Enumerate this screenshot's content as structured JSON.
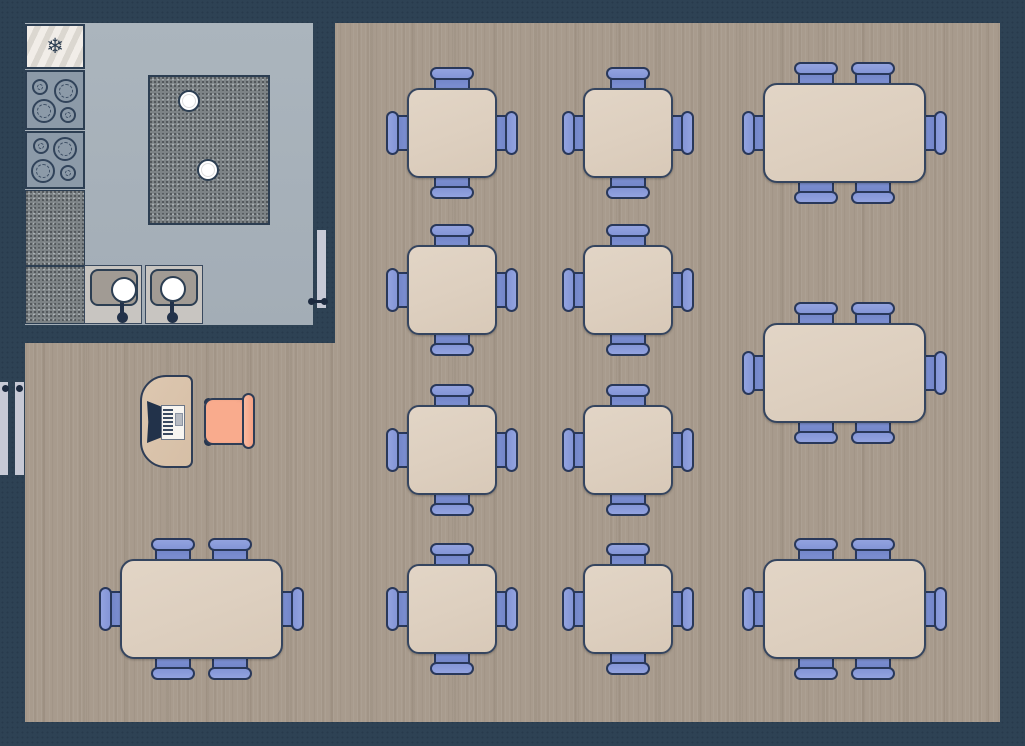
{
  "app": {
    "type": "floor-plan",
    "description": "Restaurant floor plan: kitchen (top-left) and dining area with tables and chairs"
  },
  "canvas": {
    "width": 1025,
    "height": 746
  },
  "colors": {
    "wall": "#2e4254",
    "kitchen_floor": "#a6b0b9",
    "wood_floor": "#a89b8d",
    "table_top": "#ddcfbf",
    "table_border": "#35455f",
    "chair_blue": "#7b8ed0",
    "chair_cap_blue": "#8a9bda",
    "chair_border": "#29385a",
    "desk_wood": "#d9c2a9",
    "office_chair_salmon": "#f9ab8d",
    "appliance_gray": "#8c9aa8",
    "fridge_light": "#e9e5e0",
    "granite": "#7d8386",
    "sink_counter": "#c8c5c1",
    "sink_basin": "#a19b94",
    "door_light": "#c7cad6",
    "hardware_dark": "#1d2b40"
  },
  "rooms": {
    "kitchen": {
      "label": "kitchen",
      "x": 25,
      "y": 23,
      "w": 288,
      "h": 302
    },
    "dining": {
      "label": "dining-area",
      "polygon": [
        [
          335,
          23
        ],
        [
          1000,
          23
        ],
        [
          1000,
          722
        ],
        [
          25,
          722
        ],
        [
          25,
          343
        ],
        [
          335,
          343
        ]
      ]
    }
  },
  "kitchen": {
    "fridge": {
      "x": 25,
      "y": 24,
      "w": 60,
      "h": 45,
      "icon": "❄",
      "icon_name": "snowflake-icon"
    },
    "stoves": [
      {
        "x": 25,
        "y": 70,
        "w": 60,
        "h": 60,
        "burners": [
          {
            "cx": 15,
            "cy": 17,
            "r": 8
          },
          {
            "cx": 41,
            "cy": 21,
            "r": 12
          },
          {
            "cx": 19,
            "cy": 41,
            "r": 12
          },
          {
            "cx": 43,
            "cy": 45,
            "r": 8
          }
        ]
      },
      {
        "x": 25,
        "y": 131,
        "w": 60,
        "h": 58,
        "burners": [
          {
            "cx": 16,
            "cy": 15,
            "r": 8
          },
          {
            "cx": 40,
            "cy": 18,
            "r": 12
          },
          {
            "cx": 18,
            "cy": 40,
            "r": 12
          },
          {
            "cx": 43,
            "cy": 42,
            "r": 8
          }
        ]
      }
    ],
    "counters": [
      {
        "x": 25,
        "y": 190,
        "w": 60,
        "h": 76
      },
      {
        "x": 25,
        "y": 266,
        "w": 60,
        "h": 58
      }
    ],
    "island": {
      "x": 148,
      "y": 75,
      "w": 122,
      "h": 150,
      "plates": [
        {
          "cx": 41,
          "cy": 26,
          "r": 11
        },
        {
          "cx": 60,
          "cy": 95,
          "r": 11
        }
      ]
    },
    "sinks": [
      {
        "x": 84,
        "y": 265,
        "w": 58,
        "h": 59,
        "basin": {
          "x": 6,
          "y": 4,
          "w": 48,
          "h": 37
        },
        "bowl": {
          "cx": 40,
          "cy": 25,
          "r": 13
        },
        "knob": {
          "cx": 38,
          "cy": 52,
          "r": 5.5
        }
      },
      {
        "x": 145,
        "y": 265,
        "w": 58,
        "h": 59,
        "basin": {
          "x": 5,
          "y": 4,
          "w": 48,
          "h": 37
        },
        "bowl": {
          "cx": 28,
          "cy": 24,
          "r": 13
        },
        "knob": {
          "cx": 27,
          "cy": 52,
          "r": 5.5
        }
      }
    ]
  },
  "doors": {
    "kitchen_door": {
      "x": 317,
      "y": 230,
      "w": 9,
      "h": 78,
      "handle": {
        "x1": 311,
        "x2": 324,
        "y": 301,
        "r": 3.5
      }
    },
    "service_door_panels": [
      {
        "x": 0,
        "y": 382,
        "w": 8,
        "h": 93,
        "knob": {
          "cx": 5,
          "cy": 388,
          "r": 3.5
        }
      },
      {
        "x": 15,
        "y": 382,
        "w": 9,
        "h": 93,
        "knob": {
          "cx": 19,
          "cy": 388,
          "r": 3.5
        }
      }
    ]
  },
  "dining": {
    "square_tables": {
      "seats": 4,
      "w": 90,
      "h": 90,
      "positions": [
        {
          "x": 407,
          "y": 88
        },
        {
          "x": 583,
          "y": 88
        },
        {
          "x": 407,
          "y": 245
        },
        {
          "x": 583,
          "y": 245
        },
        {
          "x": 407,
          "y": 405
        },
        {
          "x": 583,
          "y": 405
        },
        {
          "x": 407,
          "y": 564
        },
        {
          "x": 583,
          "y": 564
        }
      ]
    },
    "rect_tables": {
      "seats": 6,
      "w": 163,
      "h": 100,
      "chair_offsets_x": [
        53,
        110
      ],
      "positions": [
        {
          "x": 763,
          "y": 83
        },
        {
          "x": 763,
          "y": 323
        },
        {
          "x": 763,
          "y": 559
        },
        {
          "x": 120,
          "y": 559
        }
      ]
    },
    "host_desk": {
      "x": 140,
      "y": 375,
      "w": 53,
      "h": 93
    },
    "register": {
      "screen": {
        "x": 147,
        "y": 401,
        "w": 16,
        "h": 42
      },
      "body": {
        "x": 161,
        "y": 405,
        "w": 24,
        "h": 35
      },
      "keys": {
        "x": 163,
        "y": 409,
        "w": 10,
        "h": 27
      },
      "key": {
        "x": 175,
        "y": 413,
        "w": 8,
        "h": 13
      }
    },
    "office_chair": {
      "seat": {
        "x": 204,
        "y": 398,
        "w": 47,
        "h": 47
      },
      "back": {
        "x": 242,
        "y": 393,
        "w": 13,
        "h": 56
      },
      "wheel_r": 4.5
    }
  },
  "chair_geometry": {
    "body_breadth": 36,
    "body_depth": 30,
    "body_under_table": 14,
    "cap_breadth": 44,
    "cap_depth": 13,
    "cap_outer_offset": 21
  }
}
